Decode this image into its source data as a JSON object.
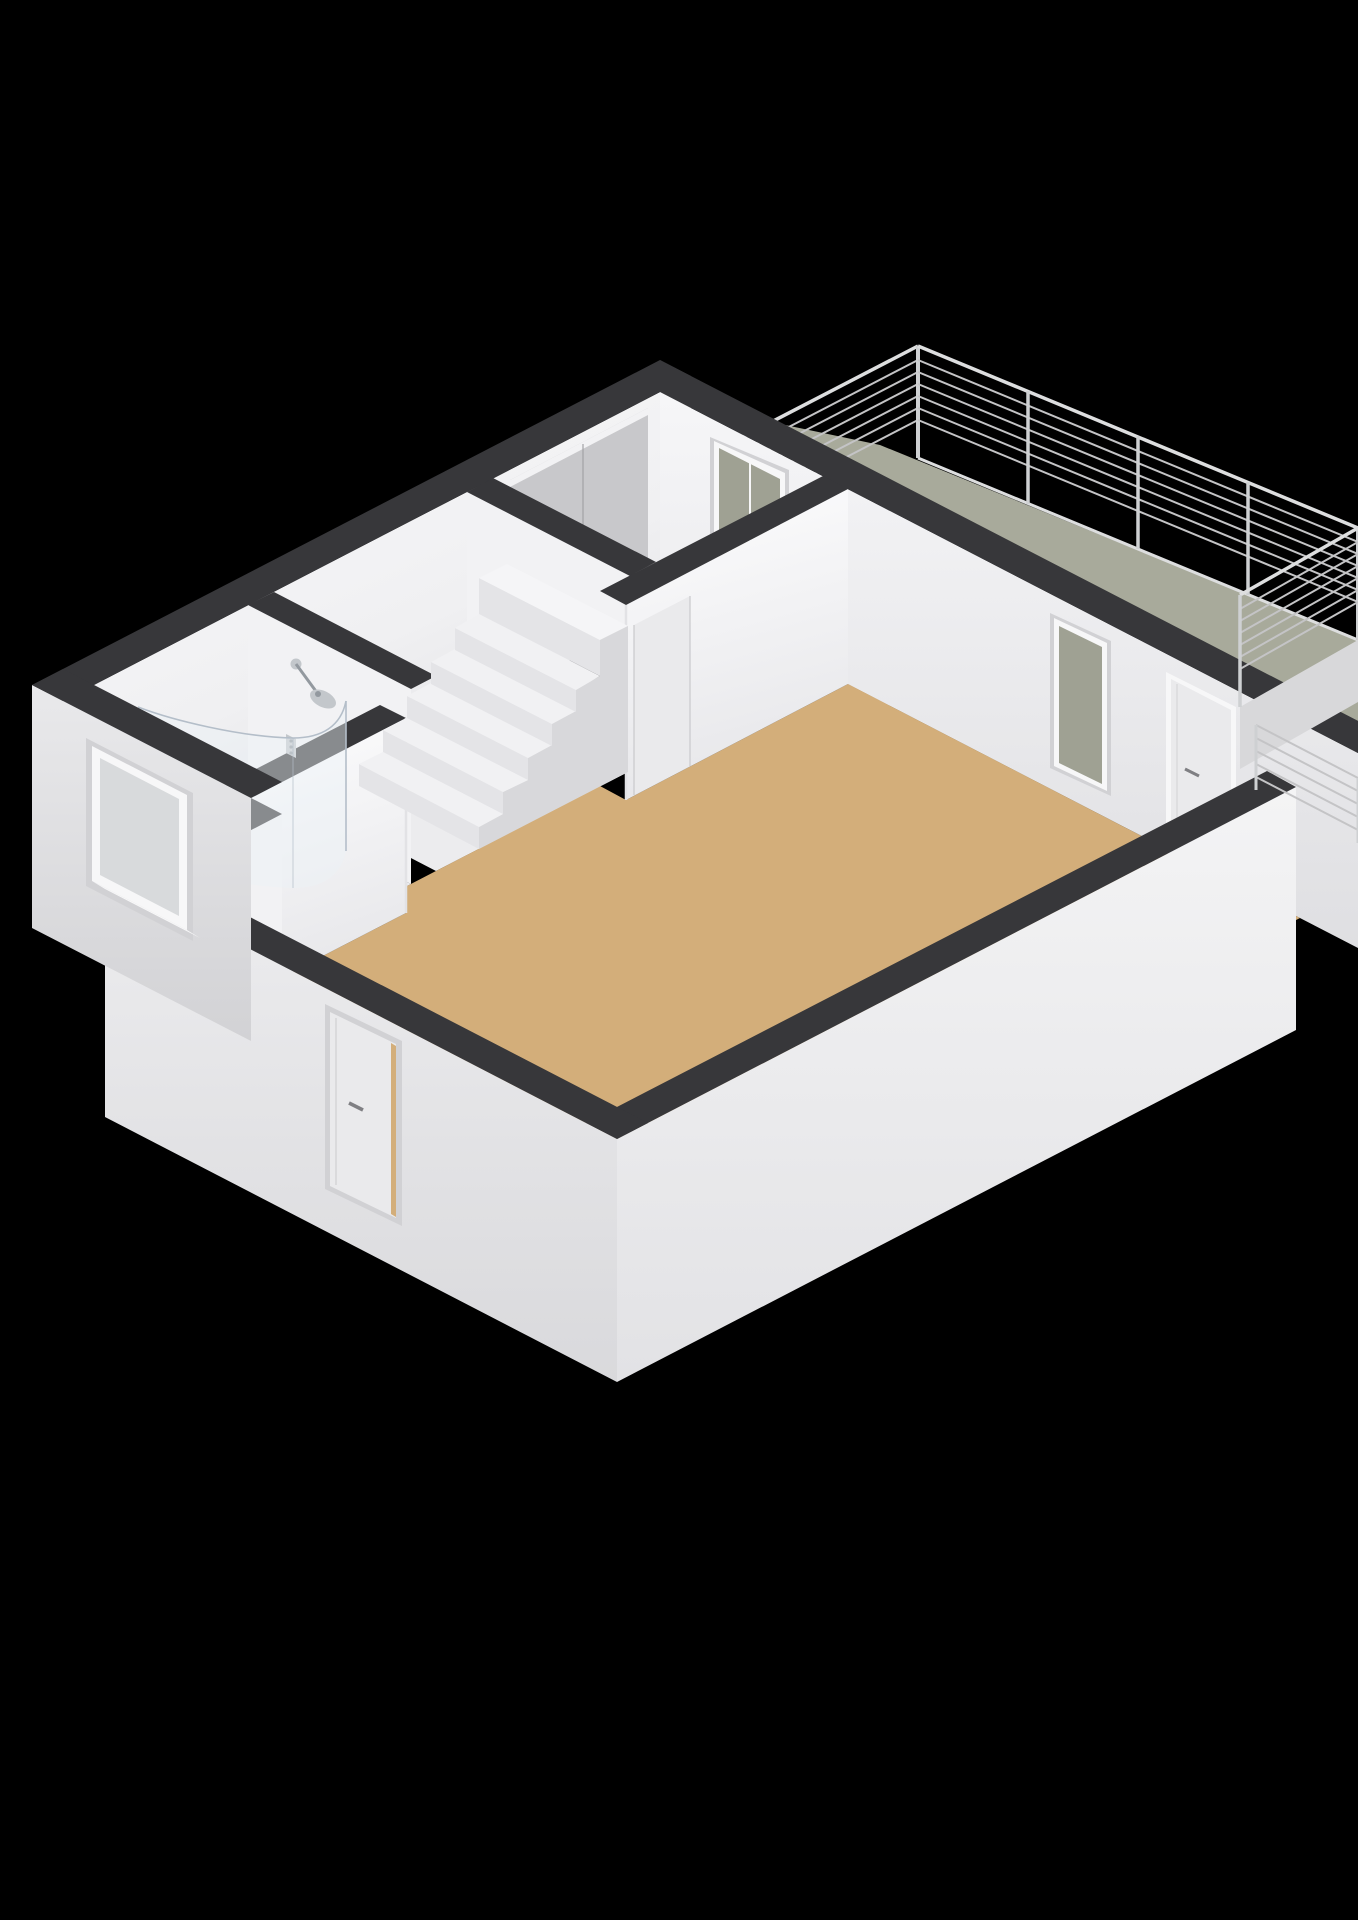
{
  "meta": {
    "type": "3d-floorplan-render",
    "projection": "isometric",
    "background": "#000000"
  },
  "colors": {
    "background": "#000000",
    "wallCap": "#37373a",
    "wallCapDark": "#2e2e31",
    "interiorWall": "#f2f2f4",
    "interiorWallShade": "#e6e6e9",
    "floorWood": "#d3ae7a",
    "floorLight": "#ececee",
    "bathFloor": "#eaebed",
    "showerFloor": "#b6c0ca",
    "showerFloorLight": "#ccd5dc",
    "balconyFloor": "#a8aa9b",
    "balconyFascia": "#d8d8da",
    "railBar": "#c4c4c6",
    "railPost": "#ced0d2",
    "railTop": "#dddedf",
    "windowFrame": "#f7f7f8",
    "windowPaneBalcony": "#9fa193",
    "windowPaneGray": "#d8dadc",
    "doorLeaf": "#eaeaec",
    "doorHandle": "#7f7f83",
    "closetPanel": "#c8c8cb",
    "reveal": "#d1d1d4",
    "stairTread": "#f1f1f3",
    "stairRiser": "#e4e4e7",
    "stairSide": "#d8d8db",
    "stairMassTop": "#f5f5f7",
    "voidDark": "#0e0e10",
    "glass": "rgba(236,242,247,0.45)",
    "glassEdge": "#b4bec9",
    "chrome": "#c3c7cb",
    "chromeDark": "#93999f"
  },
  "rooms": [
    {
      "id": "living-room",
      "floor": "wood"
    },
    {
      "id": "hallway",
      "features": [
        "staircase",
        "stairwell-opening"
      ]
    },
    {
      "id": "bathroom",
      "features": [
        "walk-in-shower",
        "exterior-window"
      ]
    },
    {
      "id": "storage-room",
      "features": [
        "closet-panels",
        "balcony-door"
      ]
    },
    {
      "id": "balcony",
      "features": [
        "metal-bar-railing",
        "fascia"
      ]
    }
  ],
  "openings": {
    "entryDoor": "exterior door on south-west wall",
    "livingRoomDoor": "door to balcony on north-east wall",
    "livingRoomWindow": "window to balcony on north-east wall",
    "balconyDoor": "glass door from storage room to balcony",
    "hallDoor": "interior door between hallway and living room",
    "bathroomWindow": "window on bathroom exterior wall"
  }
}
